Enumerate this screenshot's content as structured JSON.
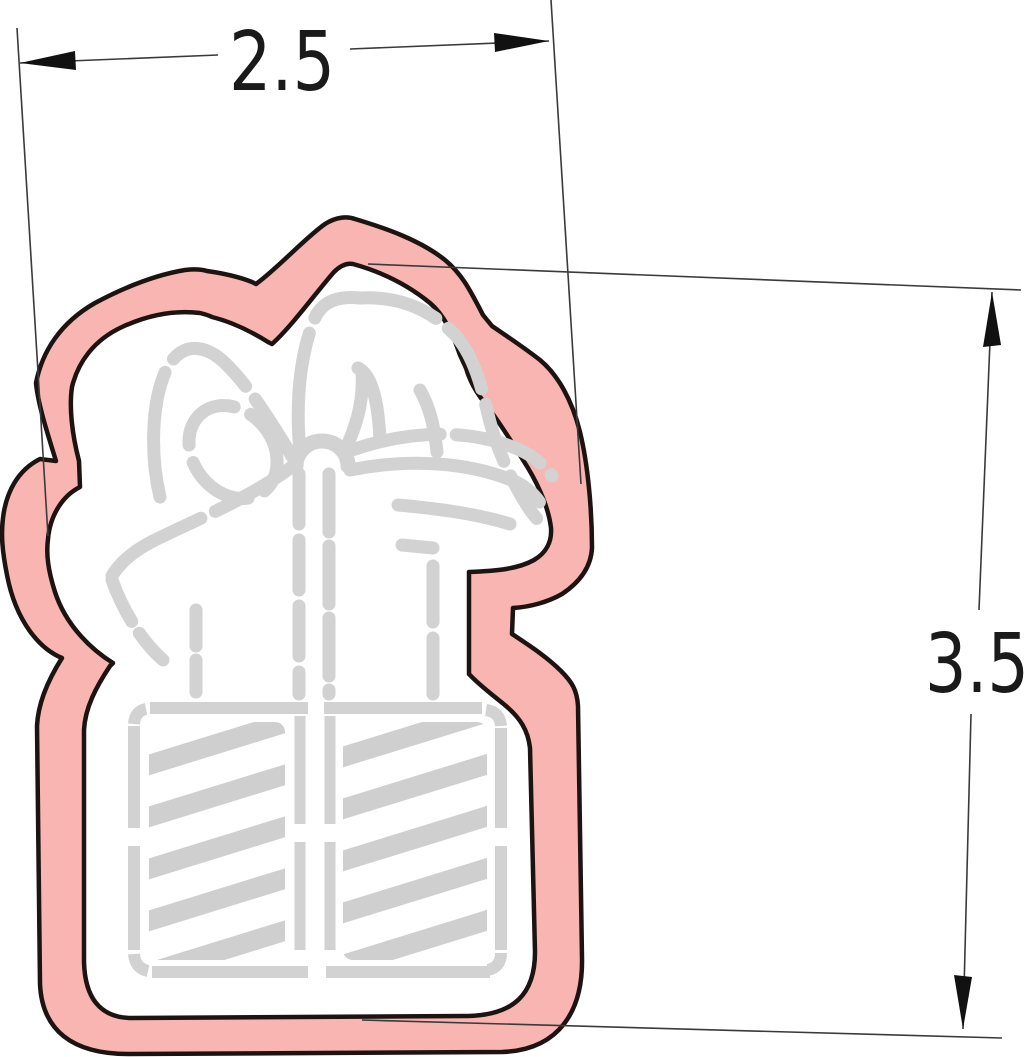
{
  "dimensions": {
    "width_label": "2.5",
    "height_label": "3.5"
  },
  "colors": {
    "background": "#ffffff",
    "cutter_fill": "#f8b5b1",
    "cutter_outline": "#1d1412",
    "stencil_gray": "#d2d2d2",
    "stripe_gray": "#cfcfcf",
    "dimension_line": "#3a3a3a",
    "arrow_fill": "#111111",
    "dimension_text": "#1a1a1a"
  }
}
